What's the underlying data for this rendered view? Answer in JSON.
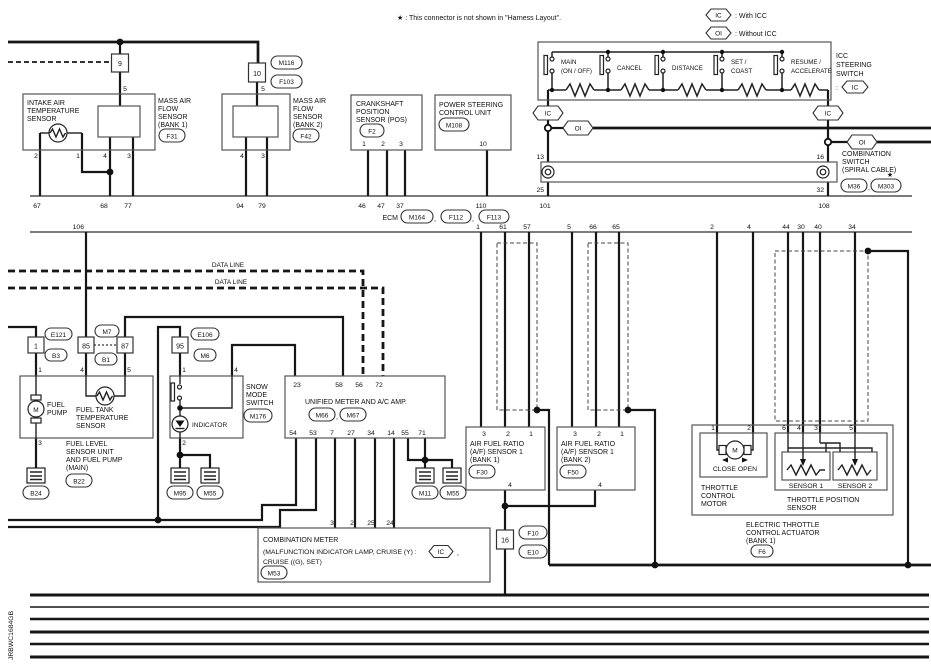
{
  "colors": {
    "ink": "#111111",
    "background": "#ffffff"
  },
  "comma": ",",
  "footnote": "★ : This connector is not shown in \"Harness Layout\".",
  "doc_code": "JRBWC1684GB",
  "legend": {
    "ic": "IC",
    "ic_desc": ": With ICC",
    "oi": "OI",
    "oi_desc": ": Without ICC"
  },
  "ecm": {
    "name": "ECM",
    "conn1": "M164",
    "conn2": "F112",
    "conn3": "F113"
  },
  "bus1_pins": {
    "p67": "67",
    "p68": "68",
    "p77": "77",
    "p94": "94",
    "p79": "79",
    "p46": "46",
    "p47": "47",
    "p37": "37",
    "p110": "110",
    "p101": "101",
    "p108": "108"
  },
  "bus2_pins": {
    "p106": "106",
    "p1": "1",
    "p61": "61",
    "p57": "57",
    "p5": "5",
    "p66": "66",
    "p65": "65",
    "p2": "2",
    "p4": "4",
    "p44": "44",
    "p30": "30",
    "p40": "40",
    "p34": "34"
  },
  "data_line": "DATA LINE",
  "iat": {
    "l1": "INTAKE AIR",
    "l2": "TEMPERATURE",
    "l3": "SENSOR"
  },
  "mafs1": {
    "l1": "MASS AIR",
    "l2": "FLOW",
    "l3": "SENSOR",
    "l4": "(BANK 1)",
    "conn": "F31",
    "inline": "9",
    "pin_top": "5",
    "p2": "2",
    "p1": "1",
    "p4": "4",
    "p3": "3"
  },
  "mafs2": {
    "l1": "MASS AIR",
    "l2": "FLOW",
    "l3": "SENSOR",
    "l4": "(BANK 2)",
    "conn": "F42",
    "inline": "10",
    "c1": "M116",
    "c2": "F103",
    "pin_top": "5",
    "p4": "4",
    "p3": "3"
  },
  "ckp": {
    "l1": "CRANKSHAFT",
    "l2": "POSITION",
    "l3": "SENSOR (POS)",
    "conn": "F2",
    "p1": "1",
    "p2": "2",
    "p3": "3"
  },
  "pscu": {
    "l1": "POWER STEERING",
    "l2": "CONTROL UNIT",
    "conn": "M108",
    "p10": "10"
  },
  "icc": {
    "t1": "ICC",
    "t2": "STEERING",
    "t3": "SWITCH",
    "colon": ":",
    "tag": "IC",
    "sw1a": "MAIN",
    "sw1b": "(ON / OFF)",
    "sw2": "CANCEL",
    "sw3": "DISTANCE",
    "sw4a": "SET /",
    "sw4b": "COAST",
    "sw5a": "RESUME /",
    "sw5b": "ACCELERATE"
  },
  "ic_oi": {
    "ic": "IC",
    "oi": "OI"
  },
  "comb_switch": {
    "p13": "13",
    "p25": "25",
    "p16": "16",
    "p32": "32",
    "t1": "COMBINATION",
    "t2": "SWITCH",
    "t3": "(SPIRAL CABLE)",
    "c1": "M36",
    "c2": "M303",
    "star": "★"
  },
  "fuel": {
    "inline1": "1",
    "e121": "E121",
    "b3": "B3",
    "c85": "85",
    "c87": "87",
    "m7": "M7",
    "b1": "B1",
    "p1": "1",
    "p4": "4",
    "p5": "5",
    "p3": "3",
    "m": "M",
    "pump1": "FUEL",
    "pump2": "PUMP",
    "tank1": "FUEL TANK",
    "tank2": "TEMPERATURE",
    "tank3": "SENSOR",
    "unit1": "FUEL LEVEL",
    "unit2": "SENSOR UNIT",
    "unit3": "AND FUEL PUMP",
    "unit4": "(MAIN)",
    "b22": "B22",
    "b24": "B24"
  },
  "snow": {
    "c95": "95",
    "e106": "E106",
    "m6": "M6",
    "p1": "1",
    "p4": "4",
    "p2": "2",
    "t1": "SNOW",
    "t2": "MODE",
    "t3": "SWITCH",
    "conn": "M176",
    "indicator": "INDICATOR",
    "g1": "M95",
    "g2": "M55"
  },
  "meter": {
    "title": "UNIFIED METER AND A/C AMP.",
    "c1": "M66",
    "c2": "M67",
    "p23": "23",
    "p58": "58",
    "p56": "56",
    "p72": "72",
    "p54": "54",
    "p53": "53",
    "p7": "7",
    "p27": "27",
    "p34": "34",
    "p14": "14",
    "p55": "55",
    "p71": "71",
    "g1": "M11",
    "g2": "M55"
  },
  "af1": {
    "l1": "AIR FUEL RATIO",
    "l2": "(A/F) SENSOR 1",
    "l3": "(BANK 1)",
    "conn": "F30",
    "p3": "3",
    "p2": "2",
    "p1": "1",
    "p4": "4"
  },
  "af2": {
    "l1": "AIR FUEL RATIO",
    "l2": "(A/F) SENSOR 1",
    "l3": "(BANK 2)",
    "conn": "F50",
    "p3": "3",
    "p2": "2",
    "p1": "1",
    "p4": "4"
  },
  "c16": {
    "label": "16",
    "f10": "F10",
    "e10": "E10"
  },
  "comb_meter": {
    "l1": "COMBINATION METER",
    "l2": "(MALFUNCTION INDICATOR LAMP, CRUISE (Y) :",
    "ic": "IC",
    "l2b": ",",
    "l3": "CRUISE ((G), SET)",
    "conn": "M53",
    "p3": "3",
    "p2": "2",
    "p25": "25",
    "p24": "24"
  },
  "throttle": {
    "p1": "1",
    "p2": "2",
    "m": "M",
    "close_open": "CLOSE  OPEN",
    "mt1": "THROTTLE",
    "mt2": "CONTROL",
    "mt3": "MOTOR",
    "p6": "6",
    "p4": "4",
    "p3": "3",
    "p5": "5",
    "s1": "SENSOR 1",
    "s2": "SENSOR 2",
    "tps1": "THROTTLE POSITION",
    "tps2": "SENSOR",
    "a1": "ELECTRIC THROTTLE",
    "a2": "CONTROL ACTUATOR",
    "a3": "(BANK 1)",
    "conn": "F6"
  }
}
